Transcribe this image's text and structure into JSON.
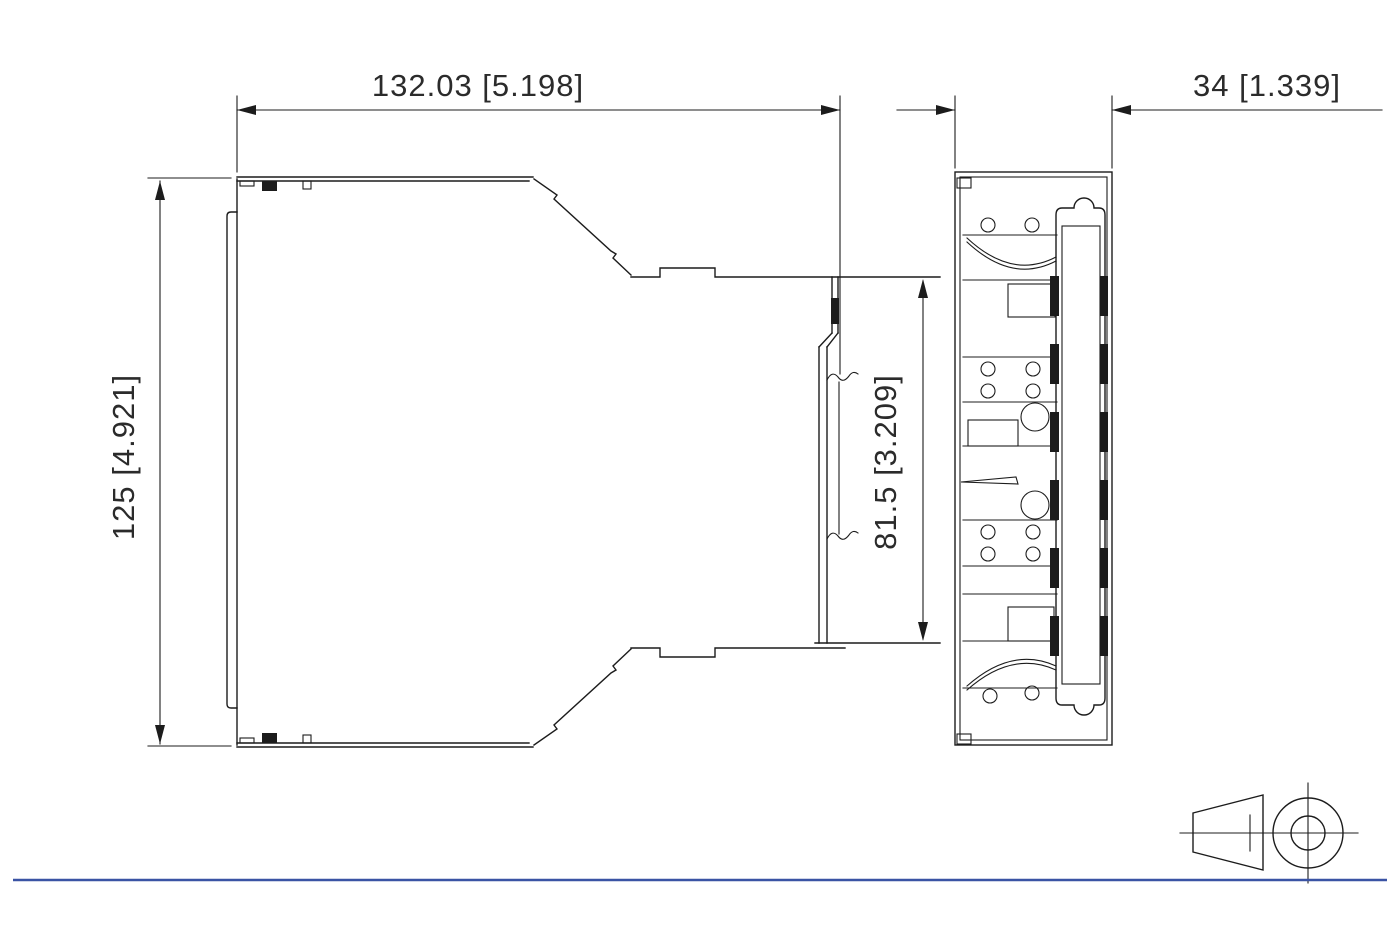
{
  "drawing": {
    "dimensions": {
      "overall_width": "132.03 [5.198]",
      "overall_depth": "34 [1.339]",
      "overall_height": "125 [4.921]",
      "din_opening": "81.5 [3.209]"
    },
    "colors": {
      "line": "#1c1c1c",
      "accent": "#3a53a4"
    },
    "symbols": {
      "projection": "third-angle-projection"
    }
  }
}
